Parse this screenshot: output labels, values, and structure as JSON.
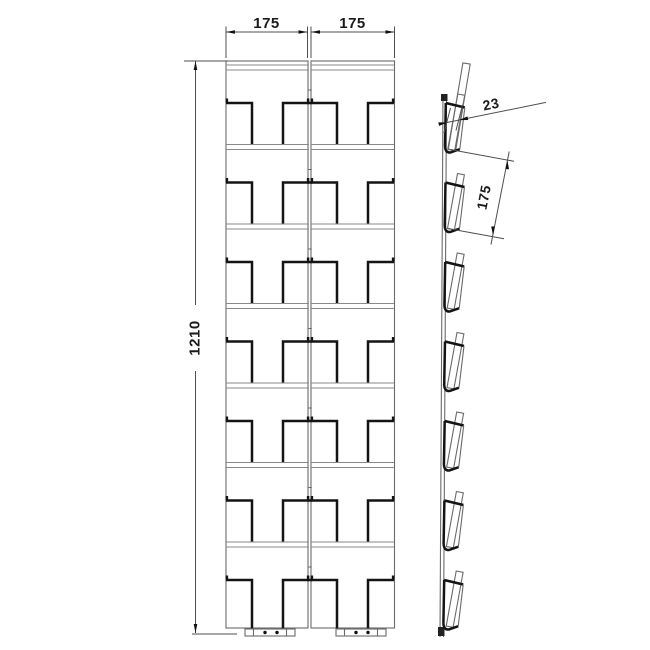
{
  "drawing": {
    "type": "technical-drawing",
    "views": {
      "front": {
        "columns": 2,
        "rows": 7
      },
      "side": {
        "pockets": 7
      }
    },
    "dimensions": {
      "width_left": "175",
      "width_right": "175",
      "height": "1210",
      "pocket_depth": "23",
      "pocket_pitch": "175"
    },
    "colors": {
      "background": "#ffffff",
      "thin_line": "#6a6a6a",
      "thick_line": "#141414",
      "dim_line": "#4f4f4f",
      "text": "#1a1a1a"
    }
  }
}
